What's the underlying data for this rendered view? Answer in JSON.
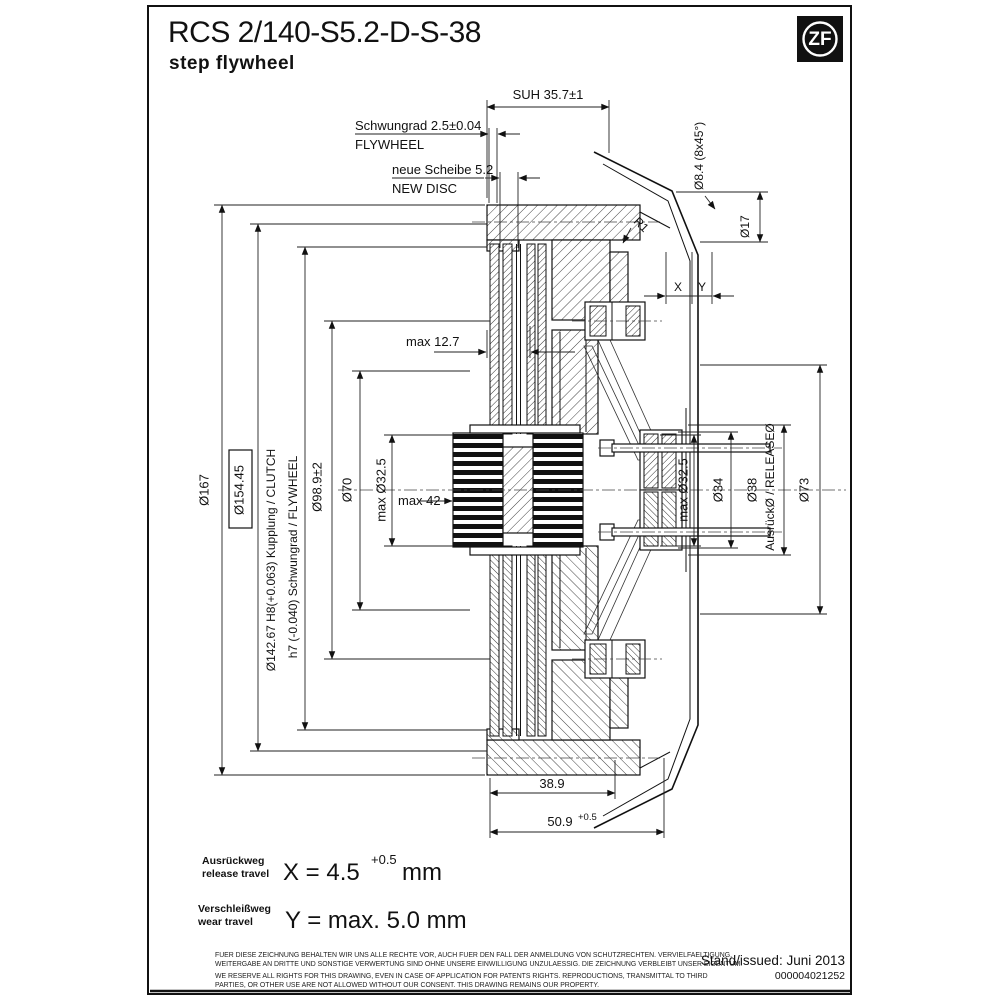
{
  "title": {
    "model": "RCS 2/140-S5.2-D-S-38",
    "type": "step flywheel"
  },
  "logo": {
    "brand": "ZF"
  },
  "dims": {
    "suh": "SUH 35.7±1",
    "flywheel_de": "Schwungrad 2.5±0.04",
    "flywheel_en": "FLYWHEEL",
    "disc_de": "neue Scheibe 5.2",
    "disc_en": "NEW DISC",
    "hole": "Ø8.4 (8x45°)",
    "d17": "Ø17",
    "r1": "R1",
    "x": "X",
    "y": "Y",
    "max127": "max 12.7",
    "d167": "Ø167",
    "d154": "Ø154.45",
    "d142_clutch": "Ø142.67 H8(+0.063) Kupplung / CLUTCH",
    "d142_flywheel": "h7 (-0.040) Schwungrad / FLYWHEEL",
    "d98": "Ø98.9±2",
    "d70": "Ø70",
    "max325": "max Ø32.5",
    "max42": "max 42",
    "d34": "Ø34",
    "d38": "Ø38",
    "release": "AusrückØ / RELEASEØ",
    "d73": "Ø73",
    "w389": "38.9",
    "w509": "50.9",
    "w509sup": "+0.5"
  },
  "travel": {
    "release_de": "Ausrückweg",
    "release_en": "release travel",
    "release_val": "X = 4.5",
    "release_sup": "+0.5",
    "release_unit": "mm",
    "wear_de": "Verschleißweg",
    "wear_en": "wear travel",
    "wear_val": "Y = max. 5.0 mm"
  },
  "footer": {
    "de1": "FUER DIESE ZEICHNUNG BEHALTEN WIR UNS ALLE RECHTE VOR, AUCH FUER DEN FALL DER ANMELDUNG VON SCHUTZRECHTEN. VERVIELFAELTIGUNG,",
    "de2": "WEITERGABE AN DRITTE UND SONSTIGE VERWERTUNG SIND OHNE UNSERE EINWILLIGUNG UNZULAESSIG. DIE ZEICHNUNG VERBLEIBT UNSER EIGENTUM.",
    "en1": "WE RESERVE ALL RIGHTS FOR THIS DRAWING, EVEN IN CASE OF APPLICATION FOR PATENTS RIGHTS. REPRODUCTIONS, TRANSMITTAL TO THIRD",
    "en2": "PARTIES, OR OTHER USE ARE NOT ALLOWED WITHOUT OUR CONSENT. THIS DRAWING REMAINS OUR PROPERTY.",
    "issued": "Stand/issued:  Juni 2013",
    "number": "000004021252"
  },
  "colors": {
    "line": "#111111",
    "background": "#ffffff"
  }
}
